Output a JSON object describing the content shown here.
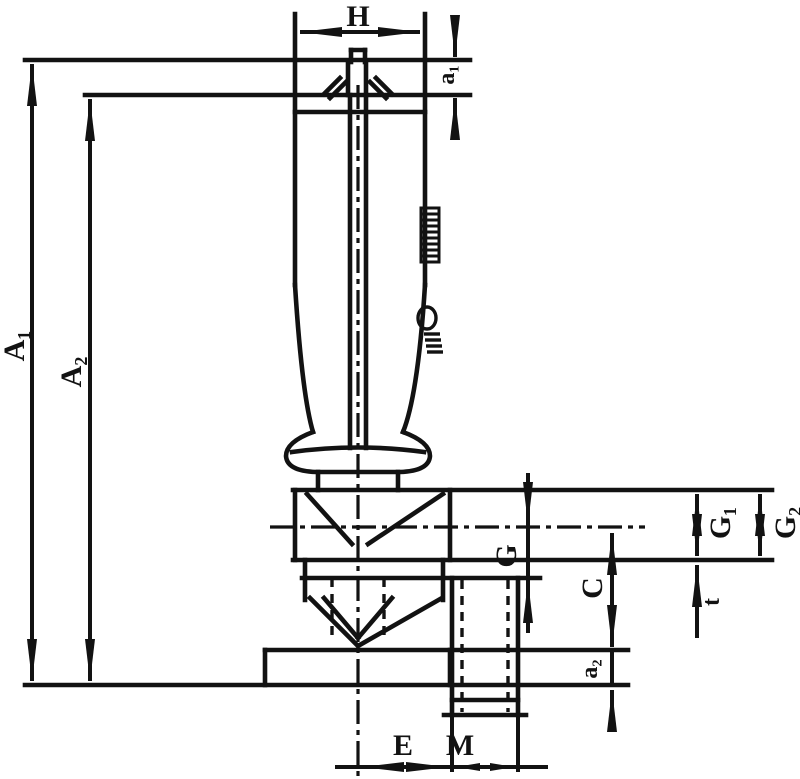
{
  "drawing": {
    "title": "Valve with extended spindle - dimension drawing",
    "colors": {
      "line": "#121212",
      "background": "#ffffff"
    },
    "labels": {
      "width_handle": "H",
      "cap_height": "a₁",
      "height_total": "A₁",
      "height_to_collar": "A₂",
      "side_thread": "G",
      "center_to_base": "C",
      "base_thickness": "a₂",
      "port_depth_1": "G₁",
      "port_depth_2": "G₂",
      "wall_offset": "t",
      "outlet_offset": "E",
      "outlet_thread": "M"
    }
  }
}
